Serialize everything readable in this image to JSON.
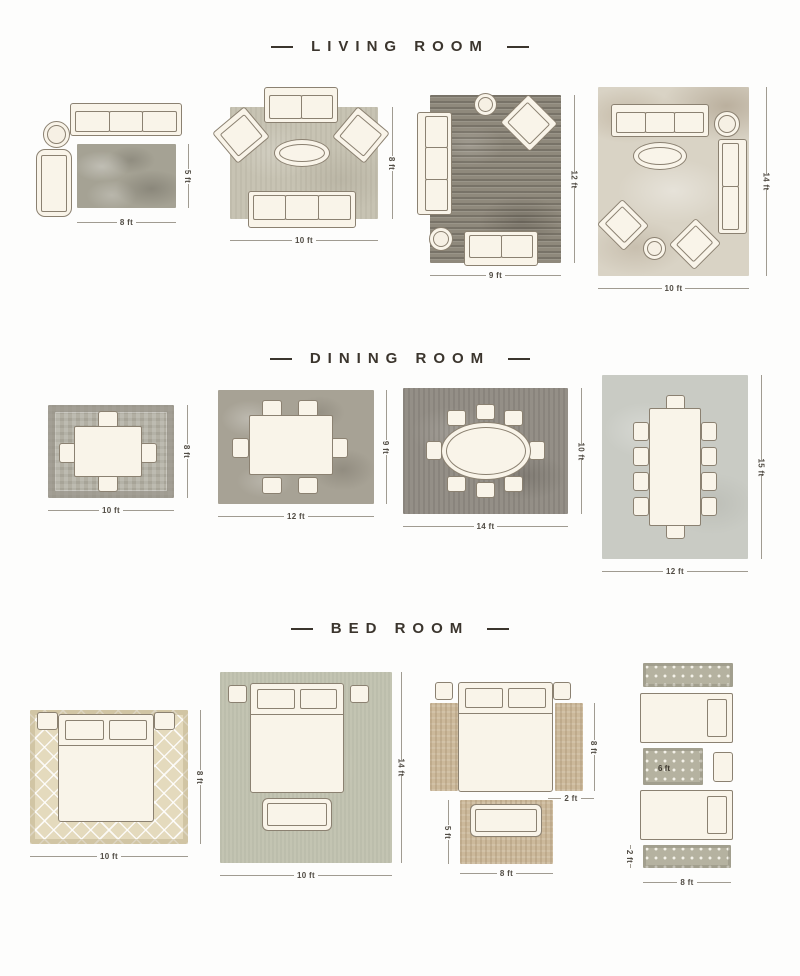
{
  "page": {
    "background": "#fdfdfc",
    "title_color": "#3b352d",
    "furniture_fill": "#f9f4e9",
    "furniture_outline": "#8b8171",
    "dim_text_color": "#514c44"
  },
  "sections": {
    "living": {
      "title": "LIVING ROOM",
      "layouts": [
        {
          "width": "8 ft",
          "height": "5 ft"
        },
        {
          "width": "10 ft",
          "height": "8 ft"
        },
        {
          "width": "9 ft",
          "height": "12 ft"
        },
        {
          "width": "10 ft",
          "height": "14 ft"
        }
      ]
    },
    "dining": {
      "title": "DINING ROOM",
      "layouts": [
        {
          "width": "10 ft",
          "height": "8 ft"
        },
        {
          "width": "12 ft",
          "height": "9 ft"
        },
        {
          "width": "14 ft",
          "height": "10 ft"
        },
        {
          "width": "12 ft",
          "height": "15 ft"
        }
      ]
    },
    "bedroom": {
      "title": "BED ROOM",
      "layouts": [
        {
          "width": "10 ft",
          "height": "8 ft"
        },
        {
          "width": "10 ft",
          "height": "14 ft"
        },
        {
          "runner_height": "8 ft",
          "runner_width": "2 ft",
          "foot_height": "5 ft",
          "foot_width": "8 ft"
        },
        {
          "middle_rug": "6 ft",
          "runner_height": "2 ft",
          "width": "8 ft"
        }
      ]
    }
  }
}
